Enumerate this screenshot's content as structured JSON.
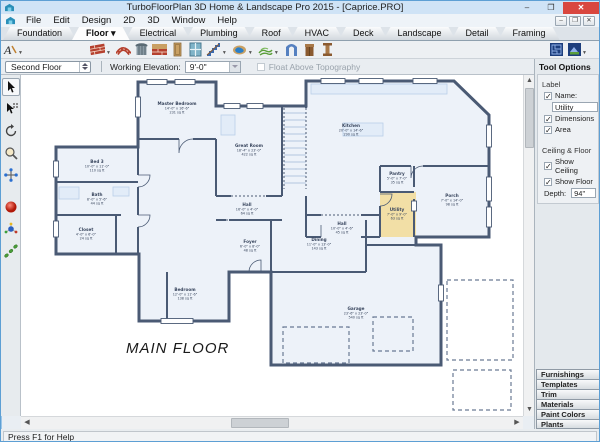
{
  "titlebar": {
    "title": "TurboFloorPlan 3D Home & Landscape Pro 2015 - [Caprice.PRO]",
    "minimize": "–",
    "maximize": "❐",
    "close": "✕"
  },
  "menubar": {
    "items": [
      "File",
      "Edit",
      "Design",
      "2D",
      "3D",
      "Window",
      "Help"
    ],
    "mdi": [
      "–",
      "❐",
      "✕"
    ]
  },
  "tabs": {
    "items": [
      {
        "label": "Foundation",
        "active": false
      },
      {
        "label": "Floor ▾",
        "active": true
      },
      {
        "label": "Electrical",
        "active": false
      },
      {
        "label": "Plumbing",
        "active": false
      },
      {
        "label": "Roof",
        "active": false
      },
      {
        "label": "HVAC",
        "active": false
      },
      {
        "label": "Deck",
        "active": false
      },
      {
        "label": "Landscape",
        "active": false
      },
      {
        "label": "Detail",
        "active": false
      },
      {
        "label": "Framing",
        "active": false
      }
    ]
  },
  "toolbar_icons": [
    "text-tool-icon",
    "wall-icon",
    "curved-wall-icon",
    "gazebo-icon",
    "half-wall-icon",
    "door-icon",
    "window-icon",
    "stairs-icon",
    "pool-icon",
    "terrain-icon",
    "arch-icon",
    "cabinet-icon",
    "column-icon",
    "plan-view-icon",
    "elevation-view-icon"
  ],
  "palette_icons": [
    "select-icon",
    "select-special-icon",
    "rotate-icon",
    "zoom-icon",
    "pan-icon",
    "render-sphere-icon",
    "walkthrough-icon",
    "path-icon"
  ],
  "floorbar": {
    "floor_value": "Second Floor",
    "elevation_label": "Working Elevation:",
    "elevation_value": "9'-0\"",
    "float_label": "Float Above Topography"
  },
  "tool_options": {
    "header": "Tool Options",
    "label_group": "Label",
    "name_label": "Name:",
    "name_value": "Utility",
    "dimensions_label": "Dimensions",
    "area_label": "Area",
    "ceiling_group": "Ceiling & Floor",
    "show_ceiling_label": "Show Ceiling",
    "show_floor_label": "Show Floor",
    "depth_label": "Depth:",
    "depth_value": "94\"",
    "checks": {
      "name": true,
      "dimensions": true,
      "area": true,
      "show_ceiling": true,
      "show_floor": true,
      "float_topo": false
    }
  },
  "catalog": {
    "buttons": [
      "Furnishings",
      "Templates",
      "Trim",
      "Materials",
      "Paint Colors",
      "Plants"
    ]
  },
  "statusbar": {
    "text": "Press F1 for Help"
  },
  "colors": {
    "accent": "#5d9fd4",
    "close_button": "#d9473f",
    "wall": "#4a5a74",
    "room_fill": "#edf2f9",
    "highlight_room": "#f2dfa6",
    "fixture": "#b9cfe8"
  },
  "floorplan": {
    "title": "MAIN FLOOR",
    "rooms": [
      {
        "name": "Master Bedroom",
        "dims": "14'-0\" x 16'-6\"",
        "area": "231 sq ft",
        "x": 156,
        "y": 30,
        "highlight": false
      },
      {
        "name": "Great Room",
        "dims": "18'-4\" x 23'-0\"",
        "area": "422 sq ft",
        "x": 228,
        "y": 72,
        "highlight": false
      },
      {
        "name": "Kitchen",
        "dims": "20'-0\" x 14'-6\"",
        "area": "290 sq ft",
        "x": 330,
        "y": 52,
        "highlight": false
      },
      {
        "name": "Pantry",
        "dims": "5'-0\" x 7'-0\"",
        "area": "35 sq ft",
        "x": 376,
        "y": 100,
        "highlight": false
      },
      {
        "name": "Porch",
        "dims": "7'-0\" x 14'-0\"",
        "area": "98 sq ft",
        "x": 431,
        "y": 122,
        "highlight": false
      },
      {
        "name": "Utility",
        "dims": "7'-0\" x 9'-0\"",
        "area": "63 sq ft",
        "x": 376,
        "y": 136,
        "highlight": true
      },
      {
        "name": "Hall",
        "dims": "16'-0\" x 4'-0\"",
        "area": "64 sq ft",
        "x": 226,
        "y": 131,
        "highlight": false
      },
      {
        "name": "Hall",
        "dims": "10'-0\" x 4'-6\"",
        "area": "45 sq ft",
        "x": 321,
        "y": 150,
        "highlight": false
      },
      {
        "name": "Foyer",
        "dims": "6'-0\" x 8'-0\"",
        "area": "48 sq ft",
        "x": 229,
        "y": 168,
        "highlight": false
      },
      {
        "name": "Dining",
        "dims": "11'-0\" x 13'-0\"",
        "area": "143 sq ft",
        "x": 298,
        "y": 166,
        "highlight": false
      },
      {
        "name": "Garage",
        "dims": "23'-6\" x 23'-0\"",
        "area": "540 sq ft",
        "x": 335,
        "y": 235,
        "highlight": false
      },
      {
        "name": "Bedroom",
        "dims": "12'-0\" x 11'-6\"",
        "area": "138 sq ft",
        "x": 164,
        "y": 216,
        "highlight": false
      },
      {
        "name": "Bed 3",
        "dims": "10'-0\" x 11'-0\"",
        "area": "110 sq ft",
        "x": 76,
        "y": 88,
        "highlight": false
      },
      {
        "name": "Bath",
        "dims": "8'-0\" x 5'-6\"",
        "area": "44 sq ft",
        "x": 76,
        "y": 121,
        "highlight": false
      },
      {
        "name": "Closet",
        "dims": "4'-0\" x 6'-0\"",
        "area": "24 sq ft",
        "x": 65,
        "y": 156,
        "highlight": false
      }
    ]
  }
}
